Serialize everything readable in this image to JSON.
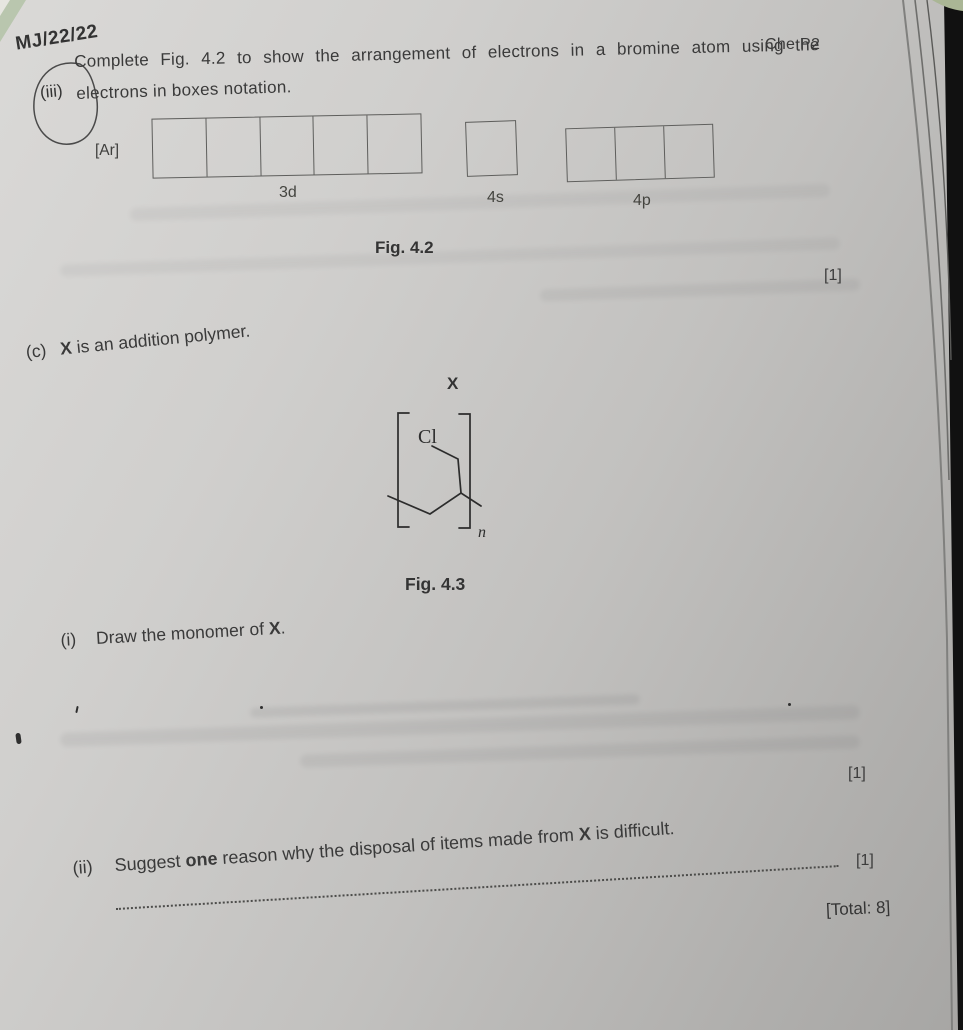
{
  "annotations": {
    "paper_code": "MJ/22/22",
    "header_right": "Che P2"
  },
  "question_iii": {
    "label": "(iii)",
    "line1": "Complete Fig. 4.2 to show the arrangement of electrons in a bromine atom using the",
    "line2": "electrons in boxes notation.",
    "noble_gas_core": "[Ar]",
    "orbital_groups": [
      {
        "label": "3d",
        "box_count": 5
      },
      {
        "label": "4s",
        "box_count": 1
      },
      {
        "label": "4p",
        "box_count": 3
      }
    ],
    "figure_caption": "Fig. 4.2",
    "marks": "[1]"
  },
  "question_c": {
    "label": "(c)",
    "bold_x": "X",
    "text_after": " is an addition polymer.",
    "structure": {
      "title": "X",
      "substituent": "Cl",
      "subscript": "n"
    },
    "figure_caption": "Fig. 4.3",
    "part_i": {
      "label": "(i)",
      "text_before": "Draw the monomer of ",
      "bold_x": "X",
      "text_after": ".",
      "marks": "[1]"
    },
    "part_ii": {
      "label": "(ii)",
      "text_1": "Suggest ",
      "bold_one": "one",
      "text_2": " reason why the disposal of items made from ",
      "bold_x": "X",
      "text_3": " is difficult.",
      "marks": "[1]"
    },
    "total": "[Total: 8]"
  },
  "colors": {
    "paper": "#c6c5c3",
    "ink": "#3a3a3a",
    "box_border": "#5e5e5c",
    "page_edge_dark": "#111111",
    "background_green": "#b2bf9e"
  }
}
